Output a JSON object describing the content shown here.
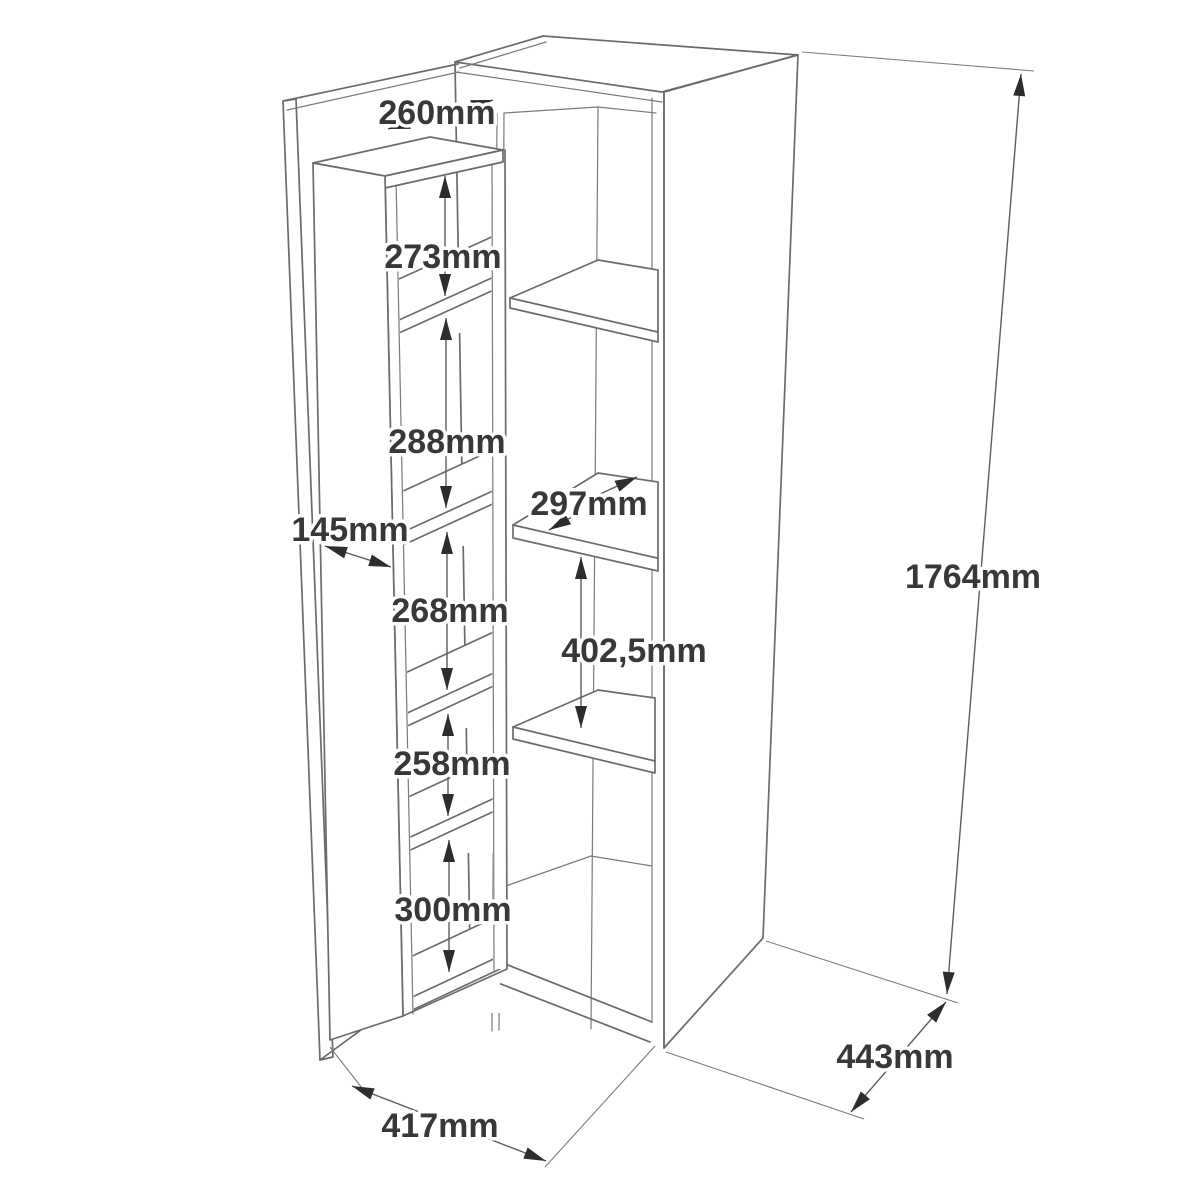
{
  "diagram": {
    "type": "furniture-assembly-dimension-diagram",
    "subject": "tall pantry cabinet with three interior shelves and an open door carrying a narrow five-compartment shelf rack",
    "background_color": "#ffffff",
    "line_color": "#6b6b6b",
    "dimension_line_color": "#5d5d5d",
    "arrow_color": "#2d2d2d",
    "label_color": "#383838",
    "units": "mm"
  },
  "dimensions": {
    "rack_width": "260mm",
    "rack_compartment_1": "273mm",
    "rack_compartment_2": "288mm",
    "rack_compartment_3": "268mm",
    "rack_compartment_4": "258mm",
    "rack_compartment_5": "300mm",
    "rack_depth": "145mm",
    "shelf_depth": "297mm",
    "shelf_spacing": "402,5mm",
    "cabinet_height": "1764mm",
    "cabinet_depth": "443mm",
    "cabinet_width": "417mm"
  }
}
